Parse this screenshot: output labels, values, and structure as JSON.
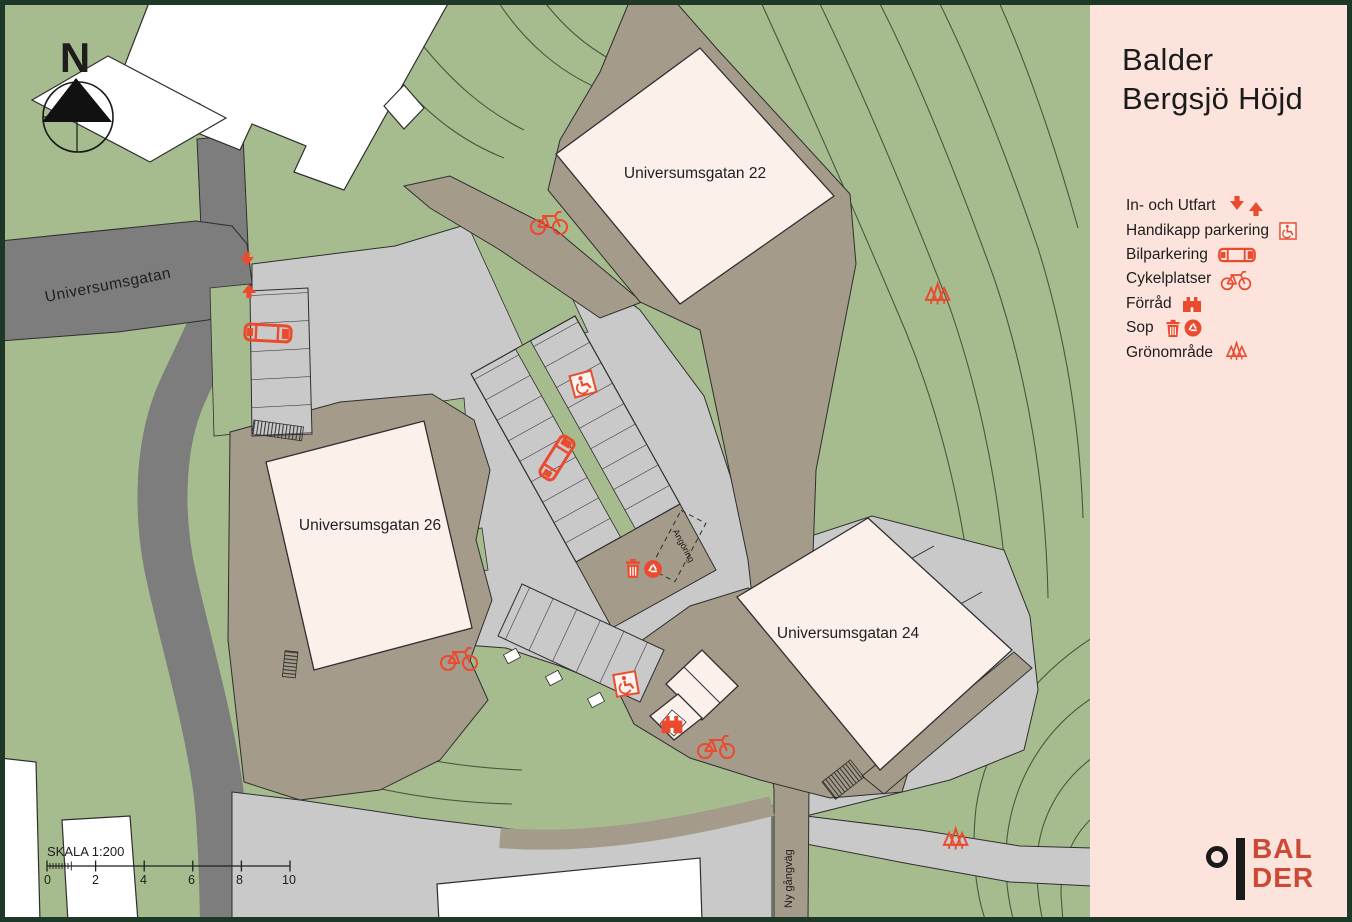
{
  "panel": {
    "title": {
      "line1": "Balder",
      "line2": "Bergsjö Höjd"
    },
    "legend": {
      "items": [
        {
          "label": "In- och Utfart",
          "icon": "entry-exit-arrows"
        },
        {
          "label": "Handikapp parkering",
          "icon": "handicap-parking"
        },
        {
          "label": "Bilparkering",
          "icon": "car"
        },
        {
          "label": "Cykelplatser",
          "icon": "bicycle"
        },
        {
          "label": "Förråd",
          "icon": "storage-shed"
        },
        {
          "label": "Sop",
          "icon": "trash-and-recycling"
        },
        {
          "label": "Grönområde",
          "icon": "trees"
        }
      ]
    },
    "logo": {
      "line1": "BAL",
      "line2": "DER"
    }
  },
  "map": {
    "north_label": "N",
    "street_label": "Universumsgatan",
    "buildings": {
      "b22": "Universumsgatan 22",
      "b26": "Universumsgatan 26",
      "b24": "Universumsgatan 24"
    },
    "annotations": {
      "delivery": "Angöring",
      "new_footpath": "Ny gångväg"
    },
    "scale": {
      "label": "SKALA 1:200",
      "ticks": [
        "0",
        "2",
        "4",
        "6",
        "8",
        "10"
      ]
    }
  },
  "colors": {
    "accent_red": "#ea4b2f",
    "logo_red": "#cc4a35",
    "map_green": "#a6bc8f",
    "road_dark_gray": "#7d7d7d",
    "paving_light_gray": "#c9c9c9",
    "path_brown": "#a49b8a",
    "building_cream": "#fbf0ea",
    "existing_building_white": "#ffffff",
    "panel_pink": "#fce4dc",
    "frame_dark_green": "#1d3826"
  }
}
